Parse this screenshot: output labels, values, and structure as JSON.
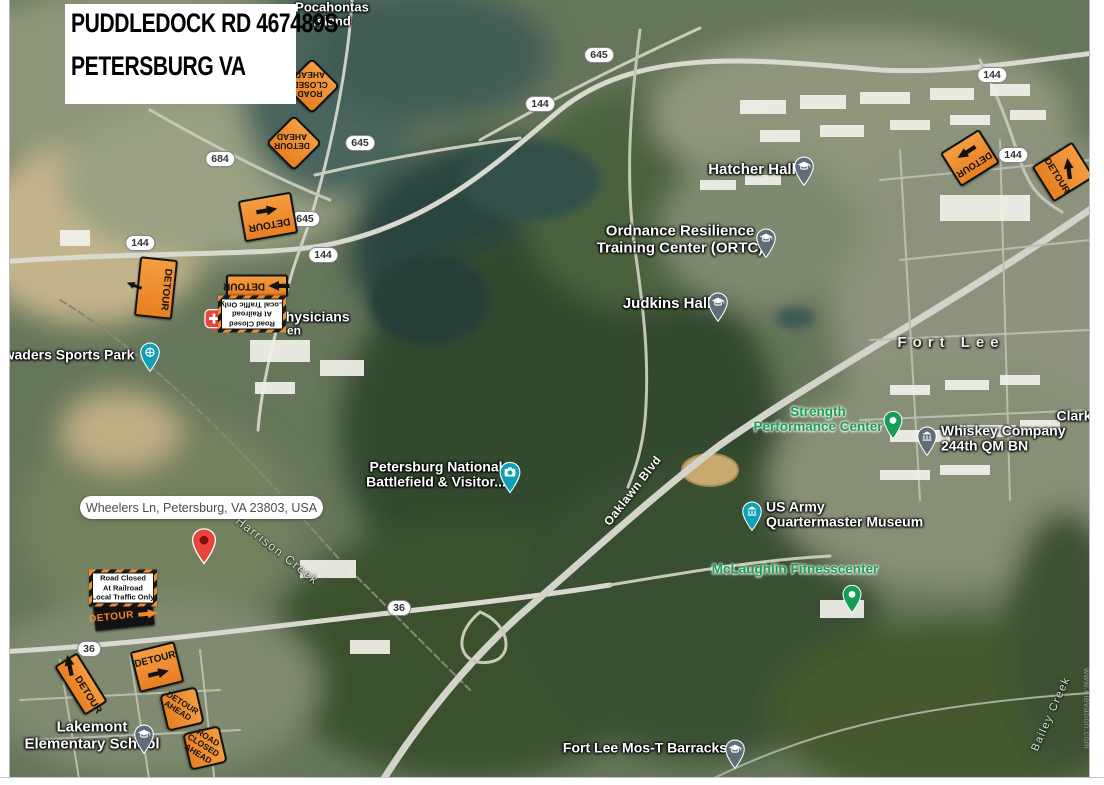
{
  "title_card": {
    "line1": "PUDDLEDOCK RD 467489S",
    "line2": "PETERSBURG VA"
  },
  "info_bubble": {
    "text": "Wheelers Ln, Petersburg, VA 23803, USA"
  },
  "watermark": {
    "text": "www.elevation.com"
  },
  "colors": {
    "sign_orange": "#f08a2e",
    "sign_black": "#121212",
    "label_green": "#1d9e52",
    "pin_teal": "#0fa0b5",
    "pin_slate": "#5f6d79",
    "pin_green": "#169c53",
    "pin_red": "#e8453c",
    "forest_green": "#33492e",
    "water_dark": "#2c443f"
  },
  "place_labels": [
    {
      "id": "pocahontas-island",
      "lines": [
        "Pocahontas",
        "Island"
      ],
      "x": 332,
      "y": 15,
      "size": 13,
      "style": "poi",
      "interact": true
    },
    {
      "id": "hatcher-hall",
      "lines": [
        "Hatcher Hall"
      ],
      "x": 752,
      "y": 170,
      "size": 15,
      "style": "poi",
      "interact": true
    },
    {
      "id": "ordnance-resilience-training-center",
      "lines": [
        "Ordnance Resilience",
        "Training Center (ORTC)"
      ],
      "x": 680,
      "y": 240,
      "size": 15,
      "style": "poi",
      "interact": true
    },
    {
      "id": "judkins-hall",
      "lines": [
        "Judkins Hall"
      ],
      "x": 667,
      "y": 304,
      "size": 15,
      "style": "poi",
      "interact": true
    },
    {
      "id": "fort-lee",
      "lines": [
        "Fort Lee"
      ],
      "x": 951,
      "y": 343,
      "size": 15,
      "style": "area",
      "interact": false
    },
    {
      "id": "strength-performance-center",
      "lines": [
        "Strength",
        "Performance Center"
      ],
      "x": 818,
      "y": 420,
      "size": 13.5,
      "style": "green",
      "interact": true
    },
    {
      "id": "whiskey-company-244th-qm-bn",
      "lines": [
        "Whiskey Company",
        "244th QM BN"
      ],
      "x": 941,
      "y": 439,
      "size": 14,
      "style": "poi",
      "align": "left",
      "interact": true
    },
    {
      "id": "clark-clipped",
      "lines": [
        "Clark"
      ],
      "x": 1074,
      "y": 416,
      "size": 14,
      "style": "poi",
      "interact": true
    },
    {
      "id": "us-army-quartermaster-museum",
      "lines": [
        "US Army",
        "Quartermaster Museum"
      ],
      "x": 766,
      "y": 515,
      "size": 14,
      "style": "poi",
      "align": "left",
      "interact": true
    },
    {
      "id": "mclaughlin-fitnesscenter",
      "lines": [
        "McLaughlin Fitnesscenter"
      ],
      "x": 795,
      "y": 570,
      "size": 13.5,
      "style": "green",
      "interact": true
    },
    {
      "id": "petersburg-national-battlefield",
      "lines": [
        "Petersburg National",
        "Battlefield & Visitor..."
      ],
      "x": 436,
      "y": 475,
      "size": 14,
      "style": "poi",
      "interact": true
    },
    {
      "id": "oaklawn-blvd",
      "lines": [
        "Oaklawn Blvd"
      ],
      "x": 633,
      "y": 491,
      "size": 12,
      "style": "road",
      "rot": -52,
      "interact": false
    },
    {
      "id": "harrison-creek",
      "lines": [
        "Harrison Creek"
      ],
      "x": 277,
      "y": 551,
      "size": 12,
      "style": "water",
      "rot": 38,
      "interact": false
    },
    {
      "id": "bailey-creek",
      "lines": [
        "Bailey Creek"
      ],
      "x": 1051,
      "y": 714,
      "size": 11,
      "style": "water",
      "rot": -66,
      "interact": false
    },
    {
      "id": "swaders-sports-park",
      "lines": [
        "waders Sports Park"
      ],
      "x": 69,
      "y": 355,
      "size": 14,
      "style": "poi",
      "interact": true
    },
    {
      "id": "physicians",
      "lines": [
        "Physicians"
      ],
      "x": 313,
      "y": 317,
      "size": 14,
      "style": "poi",
      "interact": true
    },
    {
      "id": "physicians-fragment",
      "lines": [
        "en"
      ],
      "x": 294,
      "y": 331,
      "size": 12,
      "style": "poi",
      "interact": false
    },
    {
      "id": "lakemont-elementary-school",
      "lines": [
        "Lakemont",
        "Elementary School"
      ],
      "x": 92,
      "y": 736,
      "size": 15,
      "style": "poi",
      "interact": true
    },
    {
      "id": "fort-lee-mos-t-barracks",
      "lines": [
        "Fort Lee Mos-T Barracks"
      ],
      "x": 645,
      "y": 748,
      "size": 14,
      "style": "poi",
      "interact": true
    }
  ],
  "route_shields": [
    {
      "num": "645",
      "x": 599,
      "y": 55
    },
    {
      "num": "144",
      "x": 540,
      "y": 104
    },
    {
      "num": "144",
      "x": 992,
      "y": 75
    },
    {
      "num": "144",
      "x": 1013,
      "y": 155
    },
    {
      "num": "645",
      "x": 360,
      "y": 143
    },
    {
      "num": "684",
      "x": 220,
      "y": 159
    },
    {
      "num": "645",
      "x": 305,
      "y": 219
    },
    {
      "num": "144",
      "x": 323,
      "y": 255
    },
    {
      "num": "144",
      "x": 140,
      "y": 243
    },
    {
      "num": "36",
      "x": 89,
      "y": 649
    },
    {
      "num": "36",
      "x": 399,
      "y": 608
    }
  ],
  "diamond_signs": [
    {
      "id": "road-closed-ahead-upsidedown",
      "lines": [
        "ROAD",
        "CLOSED",
        "AHEAD"
      ],
      "x": 310,
      "y": 84,
      "size": 52,
      "sq_rot": 45,
      "text_rot": 180
    },
    {
      "id": "detour-ahead-upsidedown",
      "lines": [
        "DETOUR",
        "AHEAD"
      ],
      "x": 292,
      "y": 141,
      "size": 52,
      "sq_rot": 45,
      "text_rot": 180
    },
    {
      "id": "detour-ahead-tilted",
      "lines": [
        "DETOUR",
        "AHEAD"
      ],
      "x": 180,
      "y": 707,
      "size": 48,
      "sq_rot": 77,
      "text_rot": 32
    },
    {
      "id": "road-closed-ahead-tilted",
      "lines": [
        "ROAD",
        "CLOSED",
        "AHEAD"
      ],
      "x": 203,
      "y": 746,
      "size": 48,
      "sq_rot": 77,
      "text_rot": 32
    }
  ],
  "detour_text": "DETOUR",
  "detour_rect_signs": [
    {
      "id": "detour-flipped-a",
      "x": 268,
      "y": 217,
      "w": 54,
      "h": 42,
      "rot": -10,
      "dir": "col",
      "order": [
        "arrow",
        "text"
      ],
      "arrow_ang": 0,
      "flip": true,
      "fs": 10
    },
    {
      "id": "detour-flipped-b",
      "x": 257,
      "y": 286,
      "w": 62,
      "h": 23,
      "rot": 0,
      "dir": "row",
      "order": [
        "text",
        "arrow"
      ],
      "arrow_ang": 180,
      "flip": true,
      "fs": 10
    },
    {
      "id": "detour-vertical",
      "x": 156,
      "y": 288,
      "w": 38,
      "h": 60,
      "rot": 6,
      "dir": "vert",
      "order": [
        "arrow",
        "text"
      ],
      "arrow_ang": 195,
      "flip": false,
      "fs": 10
    },
    {
      "id": "detour-tilted",
      "x": 157,
      "y": 667,
      "w": 46,
      "h": 42,
      "rot": -14,
      "dir": "col",
      "order": [
        "text",
        "arrow"
      ],
      "arrow_ang": 0,
      "flip": false,
      "fs": 10
    },
    {
      "id": "detour-diagonal",
      "x": 81,
      "y": 684,
      "w": 58,
      "h": 27,
      "rot": 58,
      "dir": "row",
      "order": [
        "arrow",
        "text"
      ],
      "arrow_ang": 200,
      "flip": false,
      "fs": 10
    },
    {
      "id": "detour-right-edge-a",
      "x": 970,
      "y": 158,
      "w": 46,
      "h": 40,
      "rot": -32,
      "dir": "col",
      "order": [
        "arrow",
        "text"
      ],
      "arrow_ang": 180,
      "flip": true,
      "fs": 9.5
    },
    {
      "id": "detour-right-edge-b",
      "x": 1063,
      "y": 172,
      "w": 42,
      "h": 48,
      "rot": 58,
      "dir": "col",
      "order": [
        "arrow",
        "text"
      ],
      "arrow_ang": 205,
      "flip": false,
      "fs": 9.5
    }
  ],
  "black_detour_sign": {
    "x": 124,
    "y": 616,
    "w": 58,
    "h": 23,
    "rot": -6
  },
  "road_closed_signs": [
    {
      "id": "road-closed-placard-upsidedown",
      "x": 252,
      "y": 314,
      "w": 68,
      "h": 37,
      "rot": 180,
      "lines": [
        "Road Closed",
        "At Railroad",
        "Local Traffic Only"
      ]
    },
    {
      "id": "road-closed-placard",
      "x": 123,
      "y": 588,
      "w": 68,
      "h": 37,
      "rot": 0,
      "lines": [
        "Road Closed",
        "At Railroad",
        "Local Traffic Only"
      ]
    }
  ],
  "markers": [
    {
      "id": "physicians-hospital",
      "type": "hospital",
      "x": 214,
      "y": 318
    },
    {
      "id": "swaders-sports-park",
      "type": "park",
      "x": 150,
      "y": 353
    },
    {
      "id": "battlefield-visitor-center",
      "type": "camera",
      "x": 510,
      "y": 473
    },
    {
      "id": "wheelers-ln-destination",
      "type": "redpin",
      "x": 204,
      "y": 541
    },
    {
      "id": "hatcher-hall-school",
      "type": "school",
      "x": 804,
      "y": 167
    },
    {
      "id": "ortc-school",
      "type": "school",
      "x": 766,
      "y": 239
    },
    {
      "id": "judkins-hall-school",
      "type": "school",
      "x": 718,
      "y": 303
    },
    {
      "id": "lakemont-school",
      "type": "school",
      "x": 144,
      "y": 735
    },
    {
      "id": "mos-t-barracks-school",
      "type": "school",
      "x": 735,
      "y": 750
    },
    {
      "id": "quartermaster-museum",
      "type": "museum-teal",
      "x": 752,
      "y": 512
    },
    {
      "id": "whiskey-company-museum",
      "type": "museum-slate",
      "x": 927,
      "y": 437
    },
    {
      "id": "strength-center-pin",
      "type": "greenpin",
      "x": 893,
      "y": 421
    },
    {
      "id": "mclaughlin-pin",
      "type": "greenpin",
      "x": 852,
      "y": 595
    }
  ]
}
